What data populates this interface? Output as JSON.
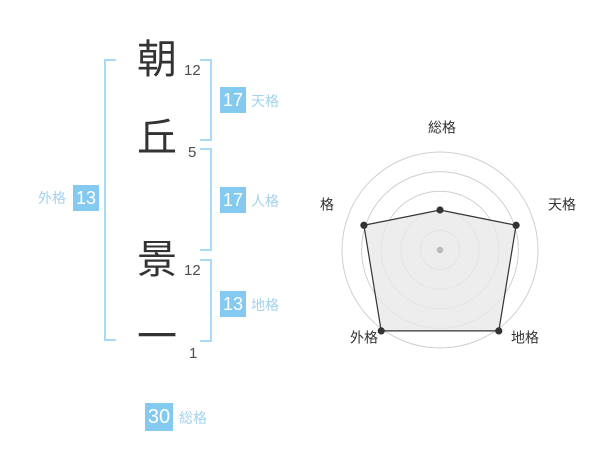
{
  "name_panel": {
    "characters": [
      {
        "char": "朝",
        "strokes": "12"
      },
      {
        "char": "丘",
        "strokes": "5"
      },
      {
        "char": "景",
        "strokes": "12"
      },
      {
        "char": "一",
        "strokes": "1"
      }
    ],
    "gokaku": {
      "tenkaku": {
        "label": "天格",
        "value": "17"
      },
      "jinkaku": {
        "label": "人格",
        "value": "17"
      },
      "chikaku": {
        "label": "地格",
        "value": "13"
      },
      "gaikaku": {
        "label": "外格",
        "value": "13"
      },
      "soukaku": {
        "label": "総格",
        "value": "30"
      }
    }
  },
  "chart_data": {
    "type": "radar",
    "axes": [
      "総格",
      "天格",
      "地格",
      "外格",
      "人格"
    ],
    "values": [
      2,
      4,
      5,
      5,
      4
    ],
    "max": 5,
    "rings": 5,
    "grid": "concentric-circles",
    "legend": "none",
    "title": ""
  },
  "colors": {
    "badge_blue": "#84caf0",
    "bracket_blue": "#a8dbf7",
    "label_blue": "#a2d2ee",
    "kanji_text": "#333333",
    "stroke_count_text": "#4d4d4d",
    "radar_stroke": "#333333",
    "radar_fill": "#e9e9e9",
    "radar_grid": "#cfcfcf",
    "radar_center_dot": "#bababa",
    "radar_label_text": "#333333"
  }
}
